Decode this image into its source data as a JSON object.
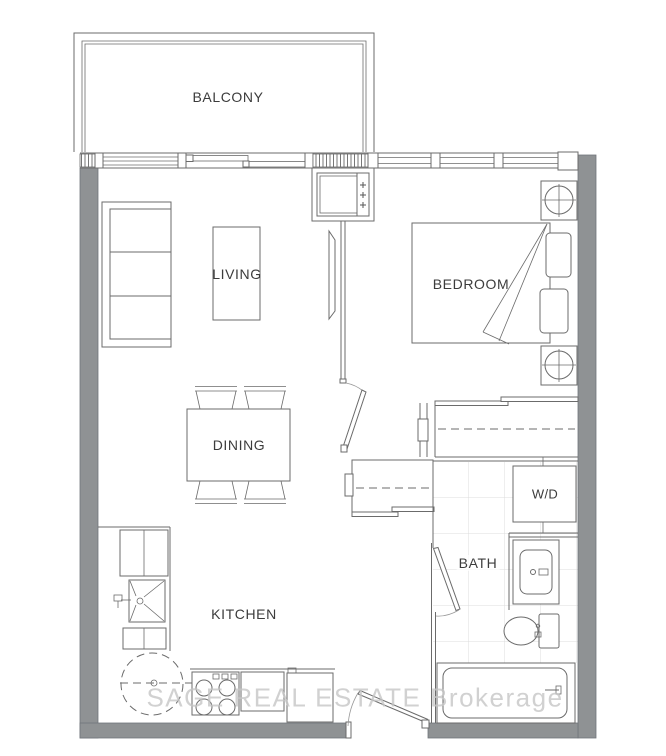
{
  "title": "1 Bedroom Condo Floor Plan",
  "rooms": {
    "balcony": "BALCONY",
    "living": "LIVING",
    "bedroom": "BEDROOM",
    "dining": "DINING",
    "kitchen": "KITCHEN",
    "bath": "BATH",
    "laundry": "W/D"
  },
  "watermark": {
    "text": "SAGE REAL ESTATE  Brokerage"
  },
  "colors": {
    "wall": "#8f9294",
    "line": "#6b6b6b",
    "label": "#3c3c3c",
    "tile": "#dcdcdc",
    "watermark": "#c6c6c6",
    "background": "#ffffff"
  }
}
